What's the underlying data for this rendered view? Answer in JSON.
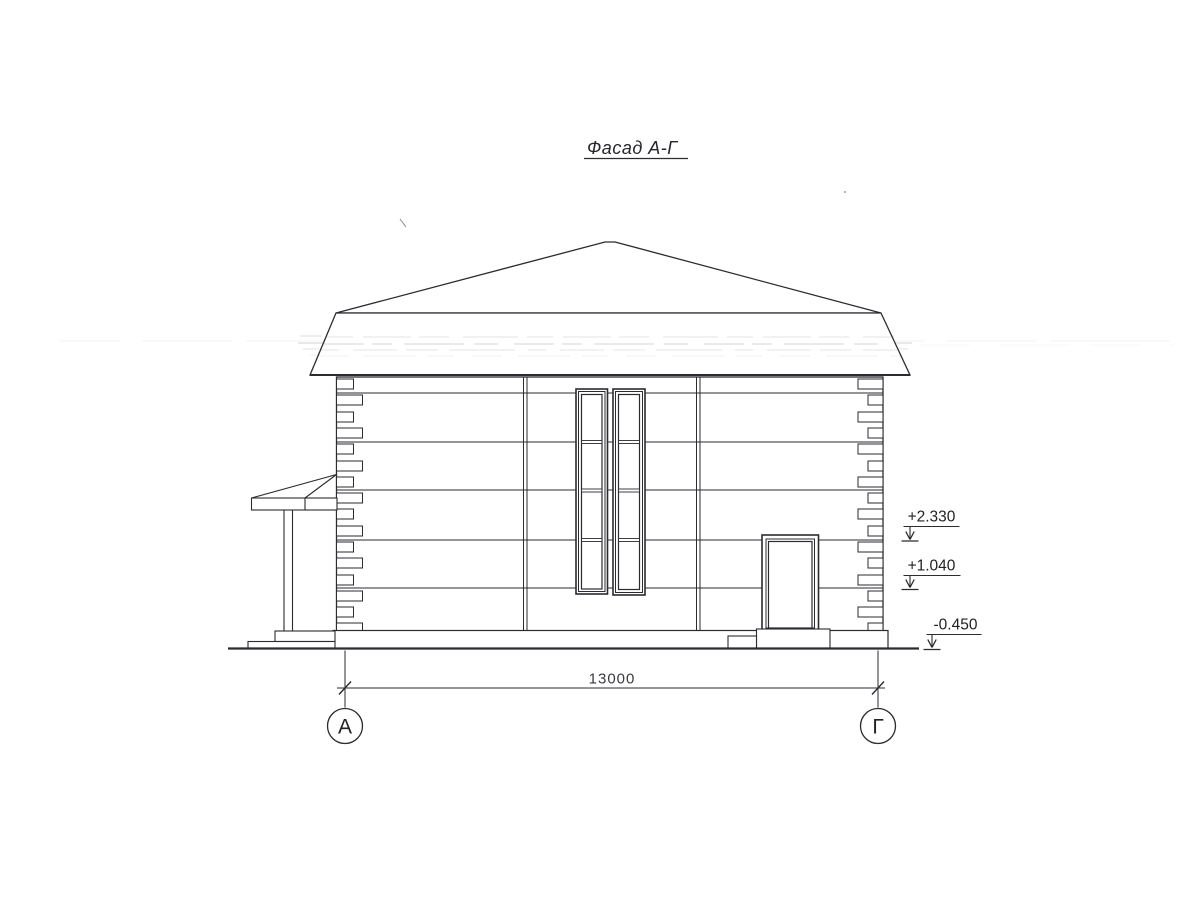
{
  "page": {
    "paper_color": "#ffffff",
    "ink_color": "#2b2b30"
  },
  "drawing": {
    "title": "Фасад А-Г",
    "dimension_label": "13000",
    "elevation_marks": [
      "+2.330",
      "+1.040",
      "-0.450"
    ],
    "axis_labels": [
      "А",
      "Г"
    ]
  }
}
